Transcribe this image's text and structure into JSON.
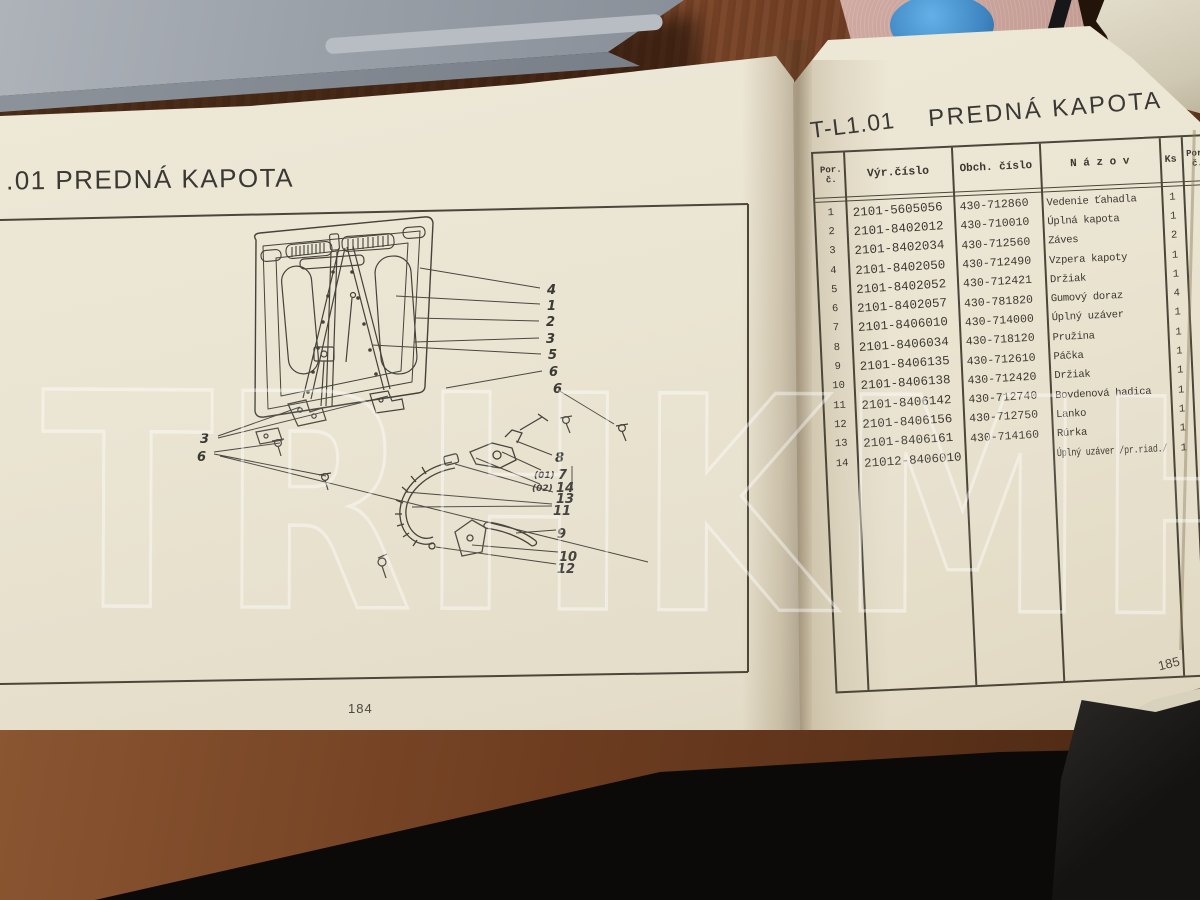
{
  "watermark": "TRHKMH",
  "left_page": {
    "title": ".01  PREDNÁ KAPOTA",
    "page_number": "184",
    "callouts": {
      "right_top": [
        "4",
        "1",
        "2",
        "3",
        "5",
        "6",
        "6"
      ],
      "left": [
        "3",
        "6"
      ],
      "bottom": [
        "8",
        "(01)",
        "7",
        "(02)",
        "14",
        "13",
        "11",
        "9",
        "10",
        "12"
      ]
    }
  },
  "right_page": {
    "code": "T-L1.01",
    "title": "PREDNÁ KAPOTA",
    "page_number": "185",
    "table": {
      "headers": {
        "por": "Por. č.",
        "vyr": "Výr.číslo",
        "obch": "Obch. číslo",
        "nazov": "N á z o v",
        "ks": "Ks",
        "por2": "Por. č."
      },
      "rows": [
        {
          "por": "1",
          "vyr": "2101-5605056",
          "obch": "430-712860",
          "nazov": "Vedenie ťahadla",
          "ks": "1"
        },
        {
          "por": "2",
          "vyr": "2101-8402012",
          "obch": "430-710010",
          "nazov": "Úplná kapota",
          "ks": "1"
        },
        {
          "por": "3",
          "vyr": "2101-8402034",
          "obch": "430-712560",
          "nazov": "Záves",
          "ks": "2"
        },
        {
          "por": "4",
          "vyr": "2101-8402050",
          "obch": "430-712490",
          "nazov": "Vzpera kapoty",
          "ks": "1"
        },
        {
          "por": "5",
          "vyr": "2101-8402052",
          "obch": "430-712421",
          "nazov": "Držiak",
          "ks": "1"
        },
        {
          "por": "6",
          "vyr": "2101-8402057",
          "obch": "430-781820",
          "nazov": "Gumový doraz",
          "ks": "4"
        },
        {
          "por": "7",
          "vyr": "2101-8406010",
          "obch": "430-714000",
          "nazov": "Úplný uzáver",
          "ks": "1"
        },
        {
          "por": "8",
          "vyr": "2101-8406034",
          "obch": "430-718120",
          "nazov": "Pružina",
          "ks": "1"
        },
        {
          "por": "9",
          "vyr": "2101-8406135",
          "obch": "430-712610",
          "nazov": "Páčka",
          "ks": "1"
        },
        {
          "por": "10",
          "vyr": "2101-8406138",
          "obch": "430-712420",
          "nazov": "Držiak",
          "ks": "1"
        },
        {
          "por": "11",
          "vyr": "2101-8406142",
          "obch": "430-712740",
          "nazov": "Bovdenová hadica",
          "ks": "1"
        },
        {
          "por": "12",
          "vyr": "2101-8406156",
          "obch": "430-712750",
          "nazov": "Lanko",
          "ks": "1"
        },
        {
          "por": "13",
          "vyr": "2101-8406161",
          "obch": "430-714160",
          "nazov": "Rúrka",
          "ks": "1"
        },
        {
          "por": "14",
          "vyr": "21012-8406010",
          "obch": "",
          "nazov": "Úplný uzáver /pr.riad./",
          "ks": "1"
        }
      ]
    }
  },
  "colors": {
    "desk_wood": "#7a4427",
    "page_paper": "#eae4d2",
    "ink": "#3b3831",
    "laptop_gray": "#9aa0a8",
    "mat_pink": "#c7a49b",
    "object_blue": "#4d9bd6",
    "watermark_stroke": "rgba(255,255,255,0.42)"
  }
}
